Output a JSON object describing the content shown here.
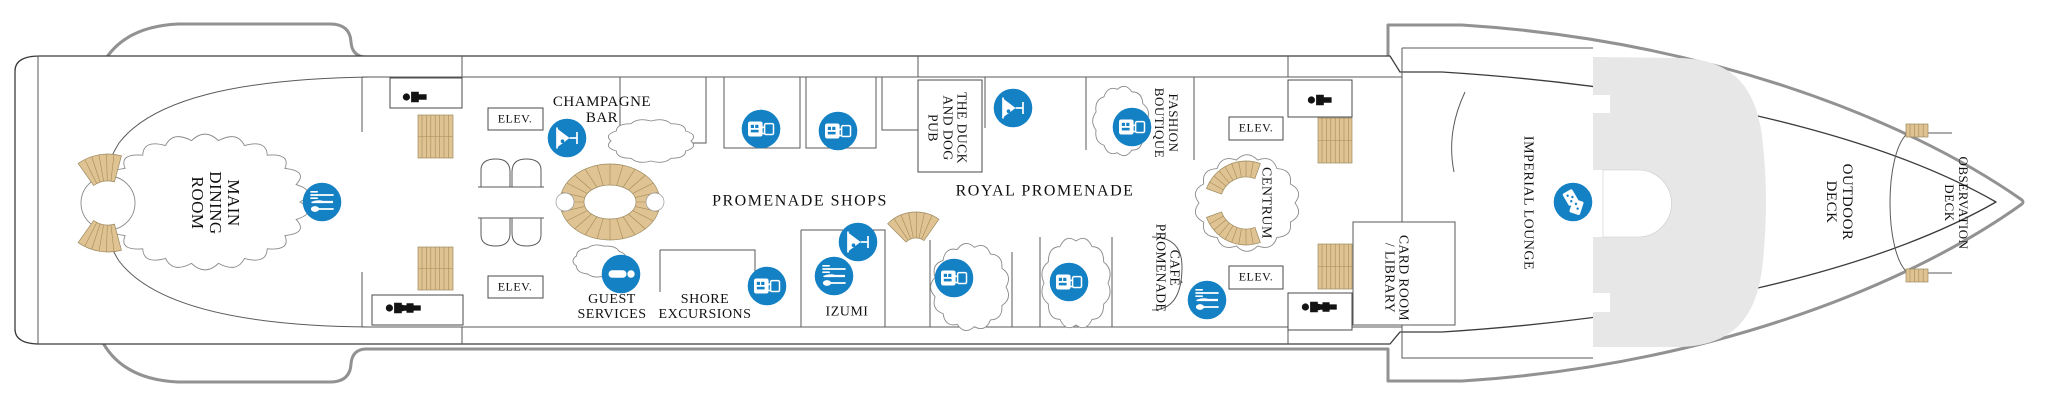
{
  "colors": {
    "icon_blue": "#1581c5",
    "stairs_tan": "#dfc393",
    "stairs_line": "#a68c58",
    "hull_gray": "#929292",
    "superstructure_fill": "#e7e7e7",
    "text": "#111111"
  },
  "labels": {
    "main_dining_room": {
      "text": "MAIN\nDINING\nROOM"
    },
    "champagne_bar": {
      "text": "CHAMPAGNE\nBAR"
    },
    "elev": {
      "text": "ELEV."
    },
    "guest_services": {
      "text": "GUEST\nSERVICES"
    },
    "shore_excursions": {
      "text": "SHORE\nEXCURSIONS"
    },
    "izumi": {
      "text": "IZUMI"
    },
    "promenade_shops": {
      "text": "PROMENADE SHOPS"
    },
    "royal_promenade": {
      "text": "ROYAL PROMENADE"
    },
    "duck_and_dog_pub": {
      "text": "THE DUCK\nAND DOG\nPUB"
    },
    "fashion_boutique": {
      "text": "FASHION\nBOUTIQUE"
    },
    "cafe_promenade": {
      "text": "CAFÉ\nPROMENADE"
    },
    "centrum": {
      "text": "CENTRUM"
    },
    "card_room_library": {
      "text": "CARD ROOM\n/ LIBRARY"
    },
    "imperial_lounge": {
      "text": "IMPERIAL LOUNGE"
    },
    "outdoor_deck": {
      "text": "OUTDOOR\nDECK"
    },
    "observation_deck": {
      "text": "OBSERVATION\nDECK"
    }
  },
  "icon_types": [
    "dining",
    "bar",
    "shopping",
    "information",
    "entertainment",
    "restroom"
  ]
}
